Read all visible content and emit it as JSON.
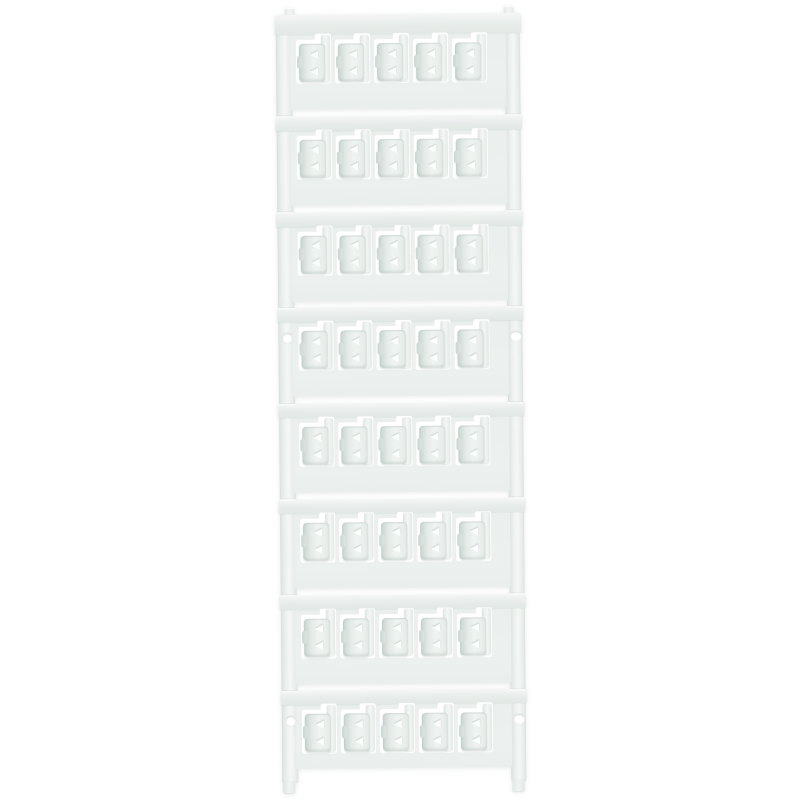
{
  "page": {
    "background_color": "#ffffff",
    "description": "Product photo of a white plastic multicard sheet of blank terminal marker tags on a carrier frame"
  },
  "card": {
    "description": "White multicard carrier with 8 horizontal strips, each holding 5 blank snap-in marker tags (40 total), two side rails, mounting holes on strips 4 and 8",
    "rows": 8,
    "markers_per_row": 5,
    "total_markers": 40,
    "mounting_hole_rows": [
      4,
      8
    ],
    "marker_text": "",
    "colors": {
      "carrier": "#eaeeec",
      "band_highlight": "#f4f6f5",
      "marker_edge": "#c8d3cf",
      "marker_face": "#eff3f1",
      "window": "#ffffff",
      "shadow": "#d4dcd9"
    }
  }
}
